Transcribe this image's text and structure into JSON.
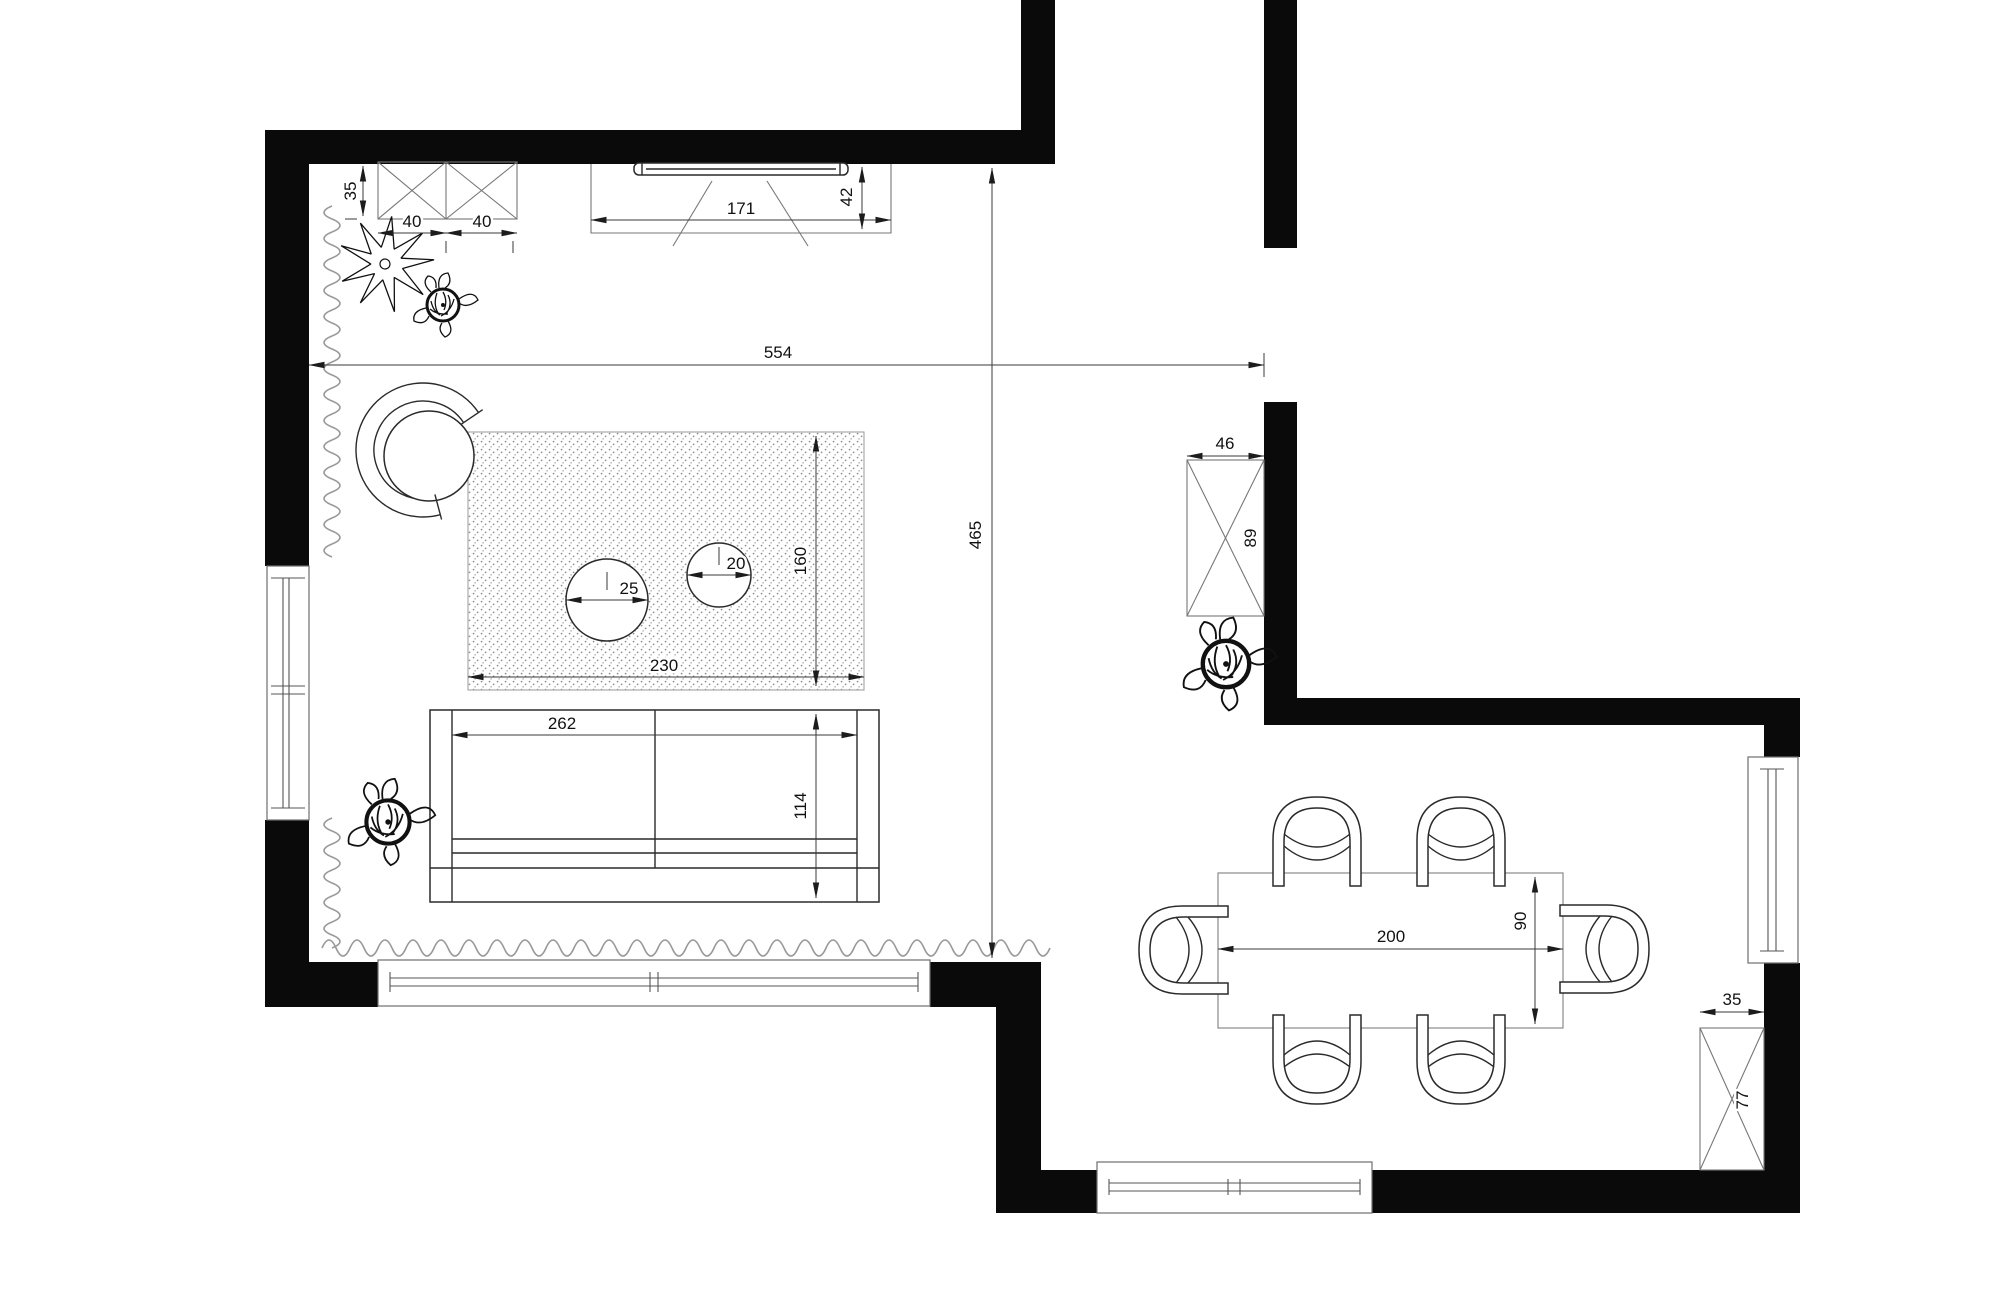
{
  "drawing_type": "apartment living-dining floor plan",
  "palette": {
    "wall": "#0a0a0a",
    "line": "#2a2a2a",
    "dimension": "#3a3a3a",
    "curtain": "#9a9a9a",
    "rug_dots": "#8f8f8f",
    "background": "#ffffff"
  },
  "dimensions": {
    "living_width": "554",
    "living_height": "465",
    "tv_unit_width": "171",
    "tv_unit_depth": "42",
    "wall_cabinet_depth": "35",
    "wall_cabinet_module_a": "40",
    "wall_cabinet_module_b": "40",
    "rug_width": "230",
    "rug_height": "160",
    "coffee_table_large_radius": "25",
    "coffee_table_small_radius": "20",
    "sofa_width": "262",
    "sofa_depth": "114",
    "hall_cabinet_width": "46",
    "hall_cabinet_height": "89",
    "dining_table_length": "200",
    "dining_table_width": "90",
    "entry_cabinet_width": "35",
    "entry_cabinet_height": "77"
  }
}
